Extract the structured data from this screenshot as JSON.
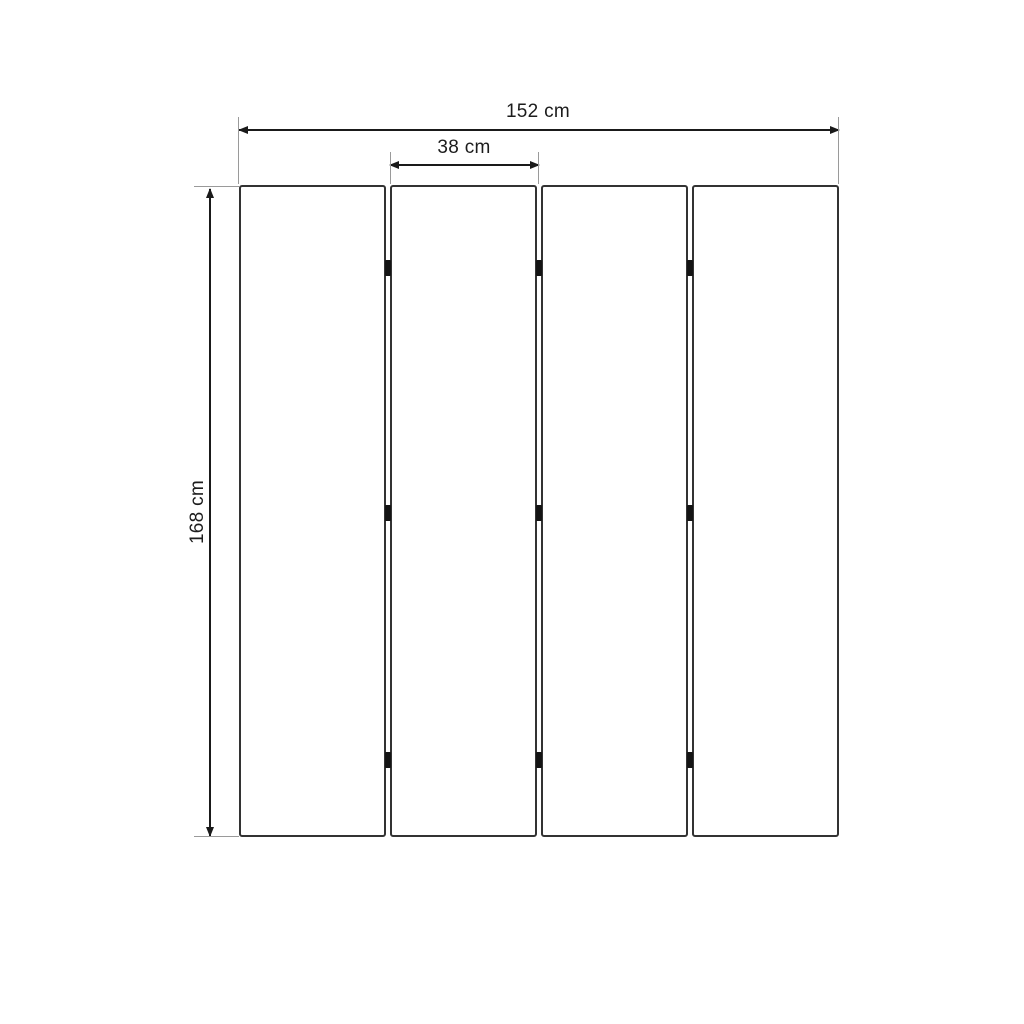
{
  "diagram": {
    "subject": "four-panel-folding-screen-dimension-drawing",
    "dimensions": {
      "total_width": {
        "label": "152 cm",
        "value": 152,
        "unit": "cm"
      },
      "panel_width": {
        "label": "38 cm",
        "value": 38,
        "unit": "cm"
      },
      "height": {
        "label": "168 cm",
        "value": 168,
        "unit": "cm"
      }
    },
    "panel_count": 4,
    "junction_count": 3,
    "hinges_per_junction": 3,
    "colors": {
      "background": "#ffffff",
      "panel_border": "#333333",
      "panel_fill": "#ffffff",
      "dimension": "#1a1a1a",
      "extension": "#9a9a9a",
      "hinge": "#141414",
      "label": "#1c1c1c"
    },
    "icons": {
      "arrow-left-icon": "css-triangle-left",
      "arrow-right-icon": "css-triangle-right",
      "arrow-up-icon": "css-triangle-up",
      "arrow-down-icon": "css-triangle-down"
    }
  }
}
